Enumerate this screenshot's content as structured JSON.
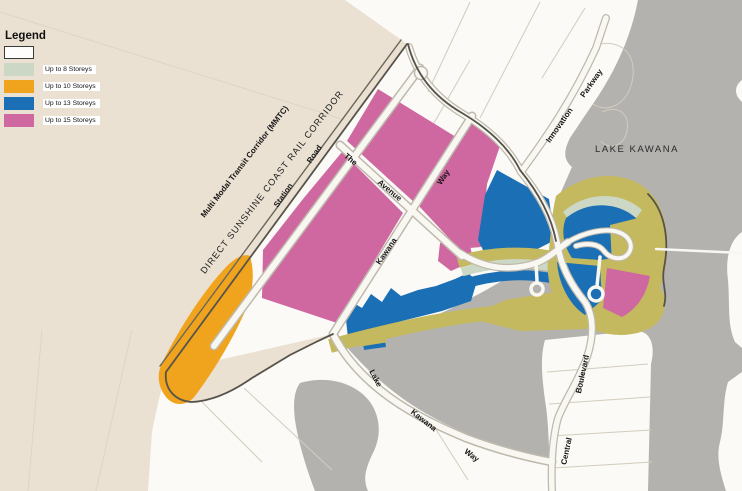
{
  "legend": {
    "title": "Legend",
    "items": [
      {
        "label": "",
        "color": "#fdfdfb",
        "bordered": true
      },
      {
        "label": "Up to 8 Storeys",
        "color": "#ccd8c5",
        "bordered": false
      },
      {
        "label": "Up to 10 Storeys",
        "color": "#f0a41d",
        "bordered": false
      },
      {
        "label": "Up to 13 Storeys",
        "color": "#1b6fb4",
        "bordered": false
      },
      {
        "label": "Up to 15 Storeys",
        "color": "#cf68a1",
        "bordered": false
      }
    ]
  },
  "map": {
    "labels": {
      "mmtc": "Multi Modal Transit Corridor (MMTC)",
      "rail_corridor": "DIRECT SUNSHINE COAST RAIL CORRIDOR",
      "station": "Station",
      "station_road": "Road",
      "the": "The",
      "avenue": "Avenue",
      "kawana": "Kawana",
      "way": "Way",
      "innovation": "Innovation",
      "parkway": "Parkway",
      "lake_kawana": "LAKE KAWANA",
      "lake2": "Lake",
      "kawana2": "Kawana",
      "way2": "Way",
      "central": "Central",
      "boulevard": "Boulevard"
    },
    "colors": {
      "land_cream": "#eae1d2",
      "parcels_white": "#fbfaf6",
      "water_gray": "#b3b2af",
      "up_to_8": "#ccd8c5",
      "up_to_10": "#f0a41d",
      "up_to_13": "#1b6fb4",
      "up_to_15": "#cf68a1",
      "open_space_olive": "#c4b95e",
      "boundary_line": "#57534b"
    }
  }
}
